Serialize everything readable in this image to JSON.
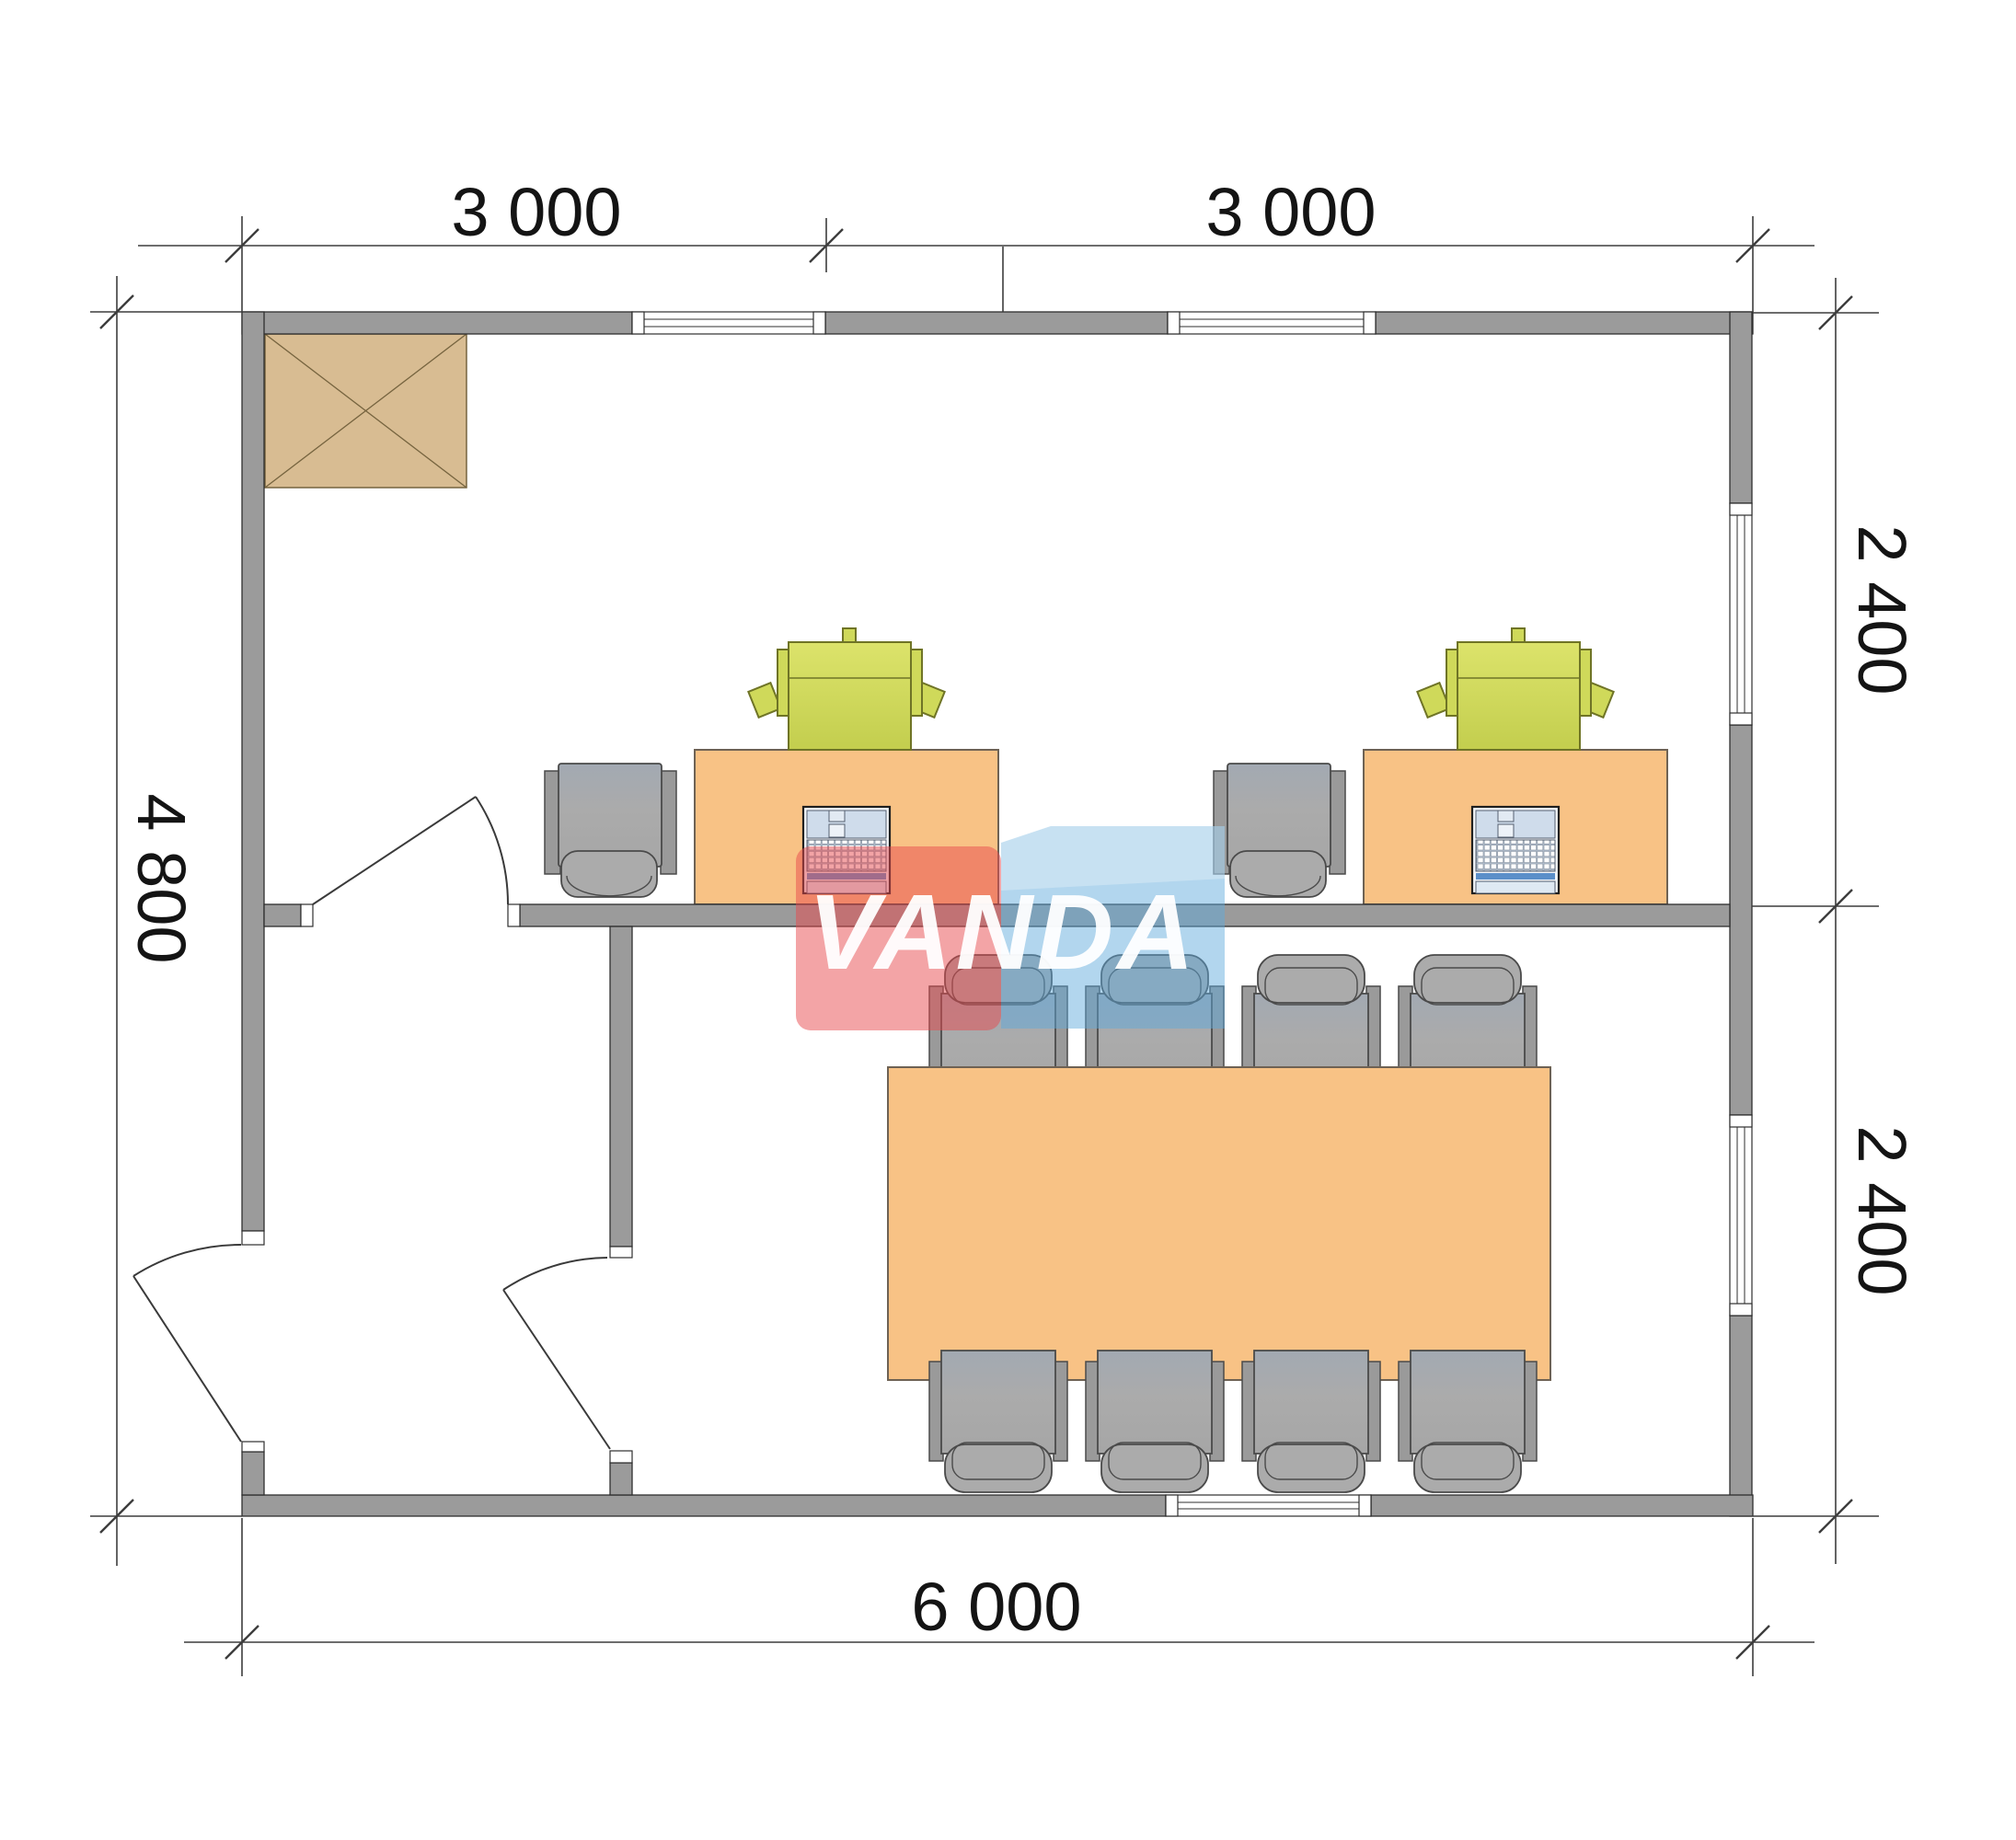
{
  "page": {
    "background": "#ffffff",
    "type": "architectural-floor-plan"
  },
  "watermark": {
    "text": "VANDA"
  },
  "dimensions": {
    "top": [
      {
        "label": "3 000"
      },
      {
        "label": "3 000"
      }
    ],
    "left": {
      "label": "4 800"
    },
    "right": [
      {
        "label": "2 400"
      },
      {
        "label": "2 400"
      }
    ],
    "bottom": {
      "label": "6 000"
    }
  },
  "plan": {
    "building_width_mm": 6000,
    "building_height_mm": 4800,
    "room_depth_top_mm": 2400,
    "room_depth_bottom_mm": 2400,
    "bay_width_mm": 3000,
    "objects": {
      "workstations": 2,
      "office_chairs": 2,
      "desks": 2,
      "laptops": 2,
      "printers": 2,
      "meeting_table": 1,
      "meeting_chairs": 8,
      "doors": 3,
      "windows": 5,
      "corner_hatch_unit": 1
    }
  },
  "colors": {
    "wall": "#9B9B9B",
    "wall-stroke": "#2F2F2F",
    "desk": "#F8C285",
    "desk-stroke": "#6E6254",
    "printer": "#CFD95A",
    "printer-stroke": "#6F7426",
    "chair": "#ABABAB",
    "chair-dark": "#9A9A9A",
    "chair-stroke": "#4A4A4A",
    "hatch-fill": "#D8BC92",
    "hatch-stroke": "#76643F",
    "laptop-screen": "#CFDCEB",
    "laptop-accent": "#5B8FC9",
    "laptop-body": "#F2F5F9",
    "dim": "#3D3D3D",
    "dim-text": "#141414",
    "wm-red": "rgba(232,73,77,0.50)",
    "wm-blue": "rgba(95,170,220,0.48)",
    "wm-text": "rgba(255,255,255,0.95)"
  }
}
